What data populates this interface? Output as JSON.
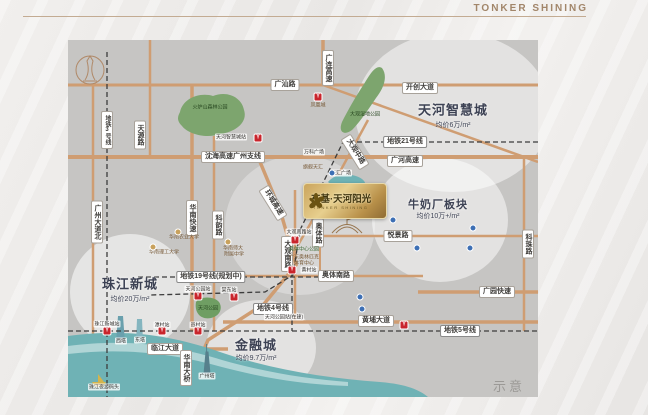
{
  "brand": {
    "name": "TONKER SHINING"
  },
  "watermark": "示意图",
  "project": {
    "title": "东基·天河阳光",
    "subtitle": "TONKER SHINING"
  },
  "map": {
    "colors": {
      "bg": "#c6c5c3",
      "road": "#cf9d72",
      "metro": "#3c3c3c",
      "river": "#6fb2b5",
      "park": "#7da56e",
      "metro_red": "#c9252c",
      "poi_blue": "#3d6fb4"
    },
    "circles": [
      {
        "cx": 385,
        "cy": 72,
        "rx": 98,
        "ry": 80,
        "o": 0.5
      },
      {
        "cx": 372,
        "cy": 180,
        "rx": 68,
        "ry": 62,
        "o": 0.5
      },
      {
        "cx": 62,
        "cy": 252,
        "rx": 60,
        "ry": 58,
        "o": 0.55
      },
      {
        "cx": 193,
        "cy": 308,
        "rx": 55,
        "ry": 48,
        "o": 0.5
      },
      {
        "cx": 232,
        "cy": 185,
        "rx": 75,
        "ry": 70,
        "o": 0.3
      }
    ],
    "roads": [
      {
        "p": "0,45 470,45",
        "w": 3
      },
      {
        "p": "255,45 470,122",
        "w": 2.5
      },
      {
        "p": "0,117 470,117",
        "w": 4
      },
      {
        "p": "250,196 470,196",
        "w": 2.5
      },
      {
        "p": "160,236 355,236",
        "w": 2.5
      },
      {
        "p": "350,252 470,252",
        "w": 3.5
      },
      {
        "p": "155,282 470,282",
        "w": 3.5
      },
      {
        "p": "0,309 160,309",
        "w": 3.5
      },
      {
        "p": "25,45 25,357",
        "w": 2.5
      },
      {
        "p": "82,0 82,117",
        "w": 2.5
      },
      {
        "p": "124,45 124,291",
        "w": 3.5
      },
      {
        "p": "146,96 146,291",
        "w": 2.5
      },
      {
        "p": "227,150 227,282",
        "w": 2.5
      },
      {
        "p": "252,160 252,236",
        "w": 2
      },
      {
        "p": "456,117 456,291",
        "w": 2.5
      },
      {
        "p": "255,0 255,45",
        "w": 3.5
      },
      {
        "p": "190,117 212,170 228,225 196,264 140,300 118,350",
        "w": 3.5
      },
      {
        "p": "300,80 262,150 230,205",
        "w": 2.5
      }
    ],
    "metros": [
      {
        "name": "地铁3号线",
        "p": "39,12 39,357"
      },
      {
        "name": "地铁21号线",
        "p": "470,102 275,102 232,190 225,235 197,252 82,255"
      },
      {
        "name": "地铁19号线",
        "p": "70,237 270,237"
      },
      {
        "name": "地铁5号线",
        "p": "0,291 470,291"
      },
      {
        "name": "地铁4号线",
        "p": "224,232 224,291"
      }
    ],
    "shapes": [
      {
        "n": "river",
        "d": "M0,296 C60,288 105,296 152,312 C205,330 258,338 312,342 C338,344 352,350 360,357 L0,357 Z",
        "f": "#6fb2b5"
      },
      {
        "n": "river-highlight",
        "d": "M0,306 C60,298 108,306 154,320 C200,333 240,339 280,342 L280,346 C230,344 196,338 150,326 C110,315 60,307 0,314 Z",
        "f": "rgba(255,255,255,0.45)"
      },
      {
        "n": "canal",
        "d": "M260,142 C268,132 286,133 294,139 C302,145 294,152 282,149 C272,147 265,147 260,142 Z",
        "f": "#6fb2b5"
      },
      {
        "n": "park-huolushan",
        "d": "M112,72 C115,58 132,52 145,56 C160,50 174,58 176,70 C180,82 168,92 152,94 C138,99 120,94 114,86 C108,80 110,76 112,72 Z",
        "f": "#7da56e"
      },
      {
        "n": "park-daguan-wetland",
        "d": "M314,28 C320,36 316,48 308,58 C300,70 292,82 284,90 C276,96 270,92 274,82 C280,70 288,56 296,44 C302,34 308,24 314,28 Z",
        "f": "#7da56e"
      },
      {
        "n": "park-tianhe",
        "d": "M128,262 C132,256 146,256 151,262 C155,268 152,276 143,278 C134,280 126,274 128,262 Z",
        "f": "#6f9e63"
      },
      {
        "n": "canton-tower-logo-icon",
        "d": "M22,17 m-14,13 a14,14 0 1,0 28,0 a14,14 0 1,0 -28,0 M17,40 C21,34 21,28 19,21 L22,16 L25,21 C23,28 23,34 27,40 M15,41 L29,41",
        "s": "#b08968",
        "w": 1
      },
      {
        "n": "stadium-icon",
        "d": "M264,193 Q279,176 294,193 M268,193 Q279,181 290,193 M279,184 L279,176 L285,178 L279,180",
        "s": "#97764f",
        "w": 1
      },
      {
        "n": "twin-tower-west-icon",
        "d": "M48,303 L50,276 L55,276 L57,303 Z",
        "f": "#6aa0ad"
      },
      {
        "n": "twin-tower-east-icon",
        "d": "M68,302 L69,279 L74,279 L75,302 Z",
        "f": "#84b5bf"
      },
      {
        "n": "canton-tower-icon",
        "d": "M136,334 L138,312 L140,312 L142,334 Z M138.6,312 L138.6,304",
        "f": "#57808c",
        "s": "#57808c",
        "w": 1
      },
      {
        "n": "boat-icon",
        "d": "M24,342 L38,342 L35,347 L27,347 Z M30,334 L30,342 L36,342 Z",
        "f": "#d4b44c"
      }
    ],
    "labels": [
      {
        "k": "pill",
        "t": "广汕路",
        "x": 217,
        "y": 45
      },
      {
        "k": "pill",
        "t": "开创大道",
        "x": 352,
        "y": 48
      },
      {
        "k": "pill",
        "t": "沈海高速广州支线",
        "x": 165,
        "y": 117
      },
      {
        "k": "pill",
        "t": "广河高速",
        "x": 337,
        "y": 121
      },
      {
        "k": "pill",
        "t": "悦景路",
        "x": 330,
        "y": 196
      },
      {
        "k": "pill",
        "t": "奥体南路",
        "x": 268,
        "y": 236
      },
      {
        "k": "pill",
        "t": "广园快速",
        "x": 429,
        "y": 252
      },
      {
        "k": "pill",
        "t": "黄埔大道",
        "x": 308,
        "y": 281
      },
      {
        "k": "pill",
        "t": "临江大道",
        "x": 97,
        "y": 309
      },
      {
        "k": "pillv",
        "t": "广连高速",
        "x": 260,
        "y": 28
      },
      {
        "k": "pillv",
        "t": "天源路",
        "x": 72,
        "y": 95
      },
      {
        "k": "pillv",
        "t": "广州大道北",
        "x": 29,
        "y": 182
      },
      {
        "k": "pillv",
        "t": "华南快速",
        "x": 124,
        "y": 178
      },
      {
        "k": "pillv",
        "t": "科韵路",
        "x": 150,
        "y": 185
      },
      {
        "k": "pillv",
        "t": "大观南路",
        "x": 219,
        "y": 214
      },
      {
        "k": "pillv",
        "t": "奥体路",
        "x": 250,
        "y": 193
      },
      {
        "k": "pillv",
        "t": "科珠路",
        "x": 460,
        "y": 204
      },
      {
        "k": "pillv",
        "t": "华南大桥",
        "x": 118,
        "y": 328
      },
      {
        "k": "pill",
        "t": "环城高速",
        "x": 205,
        "y": 163,
        "rot": 58
      },
      {
        "k": "pill",
        "t": "大观中路",
        "x": 287,
        "y": 112,
        "rot": 58
      },
      {
        "k": "pillm",
        "t": "地铁21号线",
        "x": 337,
        "y": 102
      },
      {
        "k": "pillm",
        "t": "地铁19号线(规划中)",
        "x": 143,
        "y": 237
      },
      {
        "k": "pillm",
        "t": "地铁5号线",
        "x": 392,
        "y": 291
      },
      {
        "k": "pillm",
        "t": "地铁4号线",
        "x": 205,
        "y": 269
      },
      {
        "k": "pillmv",
        "t": "地铁3号线",
        "x": 39,
        "y": 90
      },
      {
        "k": "tiny",
        "t": "天河公园站(在建)",
        "x": 216,
        "y": 277
      },
      {
        "k": "big",
        "t": "天河智慧城",
        "x": 385,
        "y": 69
      },
      {
        "k": "big2",
        "t": "牛奶厂板块",
        "x": 370,
        "y": 164
      },
      {
        "k": "big",
        "t": "珠江新城",
        "x": 62,
        "y": 243
      },
      {
        "k": "big",
        "t": "金融城",
        "x": 188,
        "y": 304
      },
      {
        "k": "price",
        "t": "均价6万/m²",
        "x": 385,
        "y": 85
      },
      {
        "k": "price",
        "t": "均价10万+/m²",
        "x": 370,
        "y": 176
      },
      {
        "k": "price",
        "t": "均价20万/m²",
        "x": 62,
        "y": 259
      },
      {
        "k": "price",
        "t": "均价9.7万/m²",
        "x": 188,
        "y": 318
      },
      {
        "k": "parkt",
        "t": "火炉山森林公园",
        "x": 142,
        "y": 67
      },
      {
        "k": "parkt",
        "t": "大观湿地公园",
        "x": 297,
        "y": 74
      },
      {
        "k": "parkt",
        "t": "天河公园",
        "x": 140,
        "y": 268
      },
      {
        "k": "tiny",
        "t": "万科广场",
        "x": 246,
        "y": 112
      },
      {
        "k": "tiny",
        "t": "天汇广场",
        "x": 273,
        "y": 133
      },
      {
        "k": "tinybr",
        "t": "旗舰天汇",
        "x": 245,
        "y": 127
      },
      {
        "k": "tiny",
        "t": "西塔",
        "x": 53,
        "y": 301
      },
      {
        "k": "tiny",
        "t": "东塔",
        "x": 72,
        "y": 300
      },
      {
        "k": "tiny",
        "t": "广州塔",
        "x": 139,
        "y": 336
      },
      {
        "k": "tiny",
        "t": "珠江夜游码头",
        "x": 36,
        "y": 347
      },
      {
        "k": "tinybr",
        "t": "凤凰城",
        "x": 250,
        "y": 65
      },
      {
        "k": "tinybr",
        "t": "华南农业大学",
        "x": 116,
        "y": 197
      },
      {
        "k": "tinybr",
        "t": "华南理工大学",
        "x": 96,
        "y": 212
      },
      {
        "k": "tinybr",
        "t": "华南师大",
        "x": 165,
        "y": 208
      },
      {
        "k": "tinybr",
        "t": "附属中学",
        "x": 166,
        "y": 214
      },
      {
        "k": "tinyg",
        "t": "奥体中心公园",
        "x": 236,
        "y": 209
      },
      {
        "k": "tinybr",
        "t": "广东奥林匹克",
        "x": 236,
        "y": 217
      },
      {
        "k": "tinybr",
        "t": "体育中心",
        "x": 236,
        "y": 223
      }
    ],
    "stations": [
      {
        "t": "天河智慧城站",
        "x": 190,
        "y": 98,
        "lx": 163,
        "ly": 97
      },
      {
        "t": "大观南路站",
        "x": 227,
        "y": 200,
        "lx": 231,
        "ly": 192
      },
      {
        "t": "黄村站",
        "x": 224,
        "y": 230,
        "lx": 241,
        "ly": 230
      },
      {
        "t": "天河公园站",
        "x": 130,
        "y": 256,
        "lx": 130,
        "ly": 249
      },
      {
        "t": "棠东站",
        "x": 166,
        "y": 257,
        "lx": 161,
        "ly": 250
      },
      {
        "t": "珠江新城站",
        "x": 39,
        "y": 291,
        "lx": 39,
        "ly": 284
      },
      {
        "t": "潭村站",
        "x": 94,
        "y": 291,
        "lx": 94,
        "ly": 285
      },
      {
        "t": "员村站",
        "x": 130,
        "y": 291,
        "lx": 130,
        "ly": 285
      },
      {
        "t": "",
        "x": 336,
        "y": 285,
        "lx": 0,
        "ly": 0
      },
      {
        "t": "",
        "x": 250,
        "y": 57,
        "lx": 0,
        "ly": 0
      }
    ],
    "dots_poi": [
      [
        325,
        180
      ],
      [
        405,
        188
      ],
      [
        349,
        208
      ],
      [
        402,
        208
      ],
      [
        292,
        257
      ],
      [
        294,
        269
      ],
      [
        264,
        133
      ]
    ],
    "dots_edu": [
      [
        110,
        192
      ],
      [
        85,
        207
      ],
      [
        160,
        202
      ]
    ]
  }
}
